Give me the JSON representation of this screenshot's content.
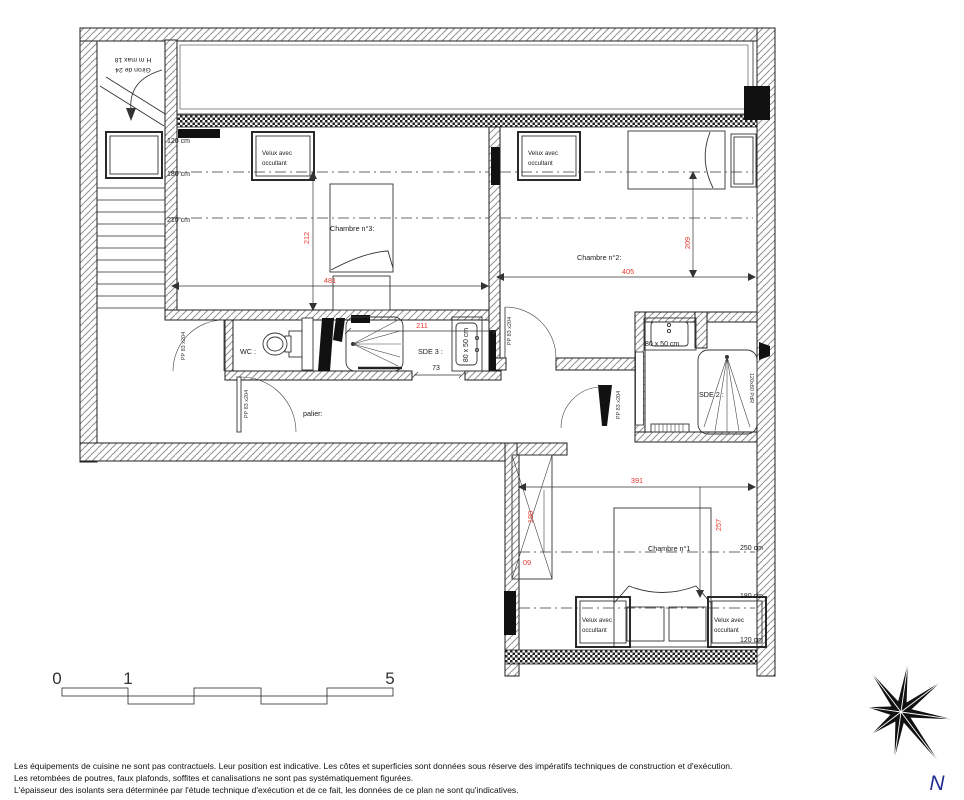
{
  "plan": {
    "rooms": {
      "bedroom3": "Chambre n°3:",
      "bedroom2": "Chambre n°2:",
      "bedroom1": "Chambre n°1",
      "wc": "WC :",
      "sde3": "SDE 3 :",
      "sde2": "SDE 2 :",
      "landing": "palier:"
    },
    "velux": {
      "line1": "Velux avec",
      "line2": "occultant"
    },
    "door_label": "PP 83 x204",
    "fixtures": {
      "basin_sde3": "80 x 50 cm",
      "basin_sde2": "80 x 50 cm",
      "shower_sde2": "120x80 PdR"
    },
    "stairs": {
      "line1": "Giron de 24",
      "line2": "H m max 18"
    },
    "dims_red": {
      "bedroom3_height": "212",
      "bedroom3_width": "481",
      "sde3_width": "211",
      "bedroom2_width": "405",
      "bedroom2_height": "209",
      "bedroom1_width": "391",
      "bedroom1_height": "257",
      "closet_height": "180",
      "closet_width": "60"
    },
    "dims_black": {
      "shower_door": "73"
    },
    "ceiling_heights": {
      "top_120": "120 cm",
      "top_180": "180 cm",
      "top_210": "210 cm",
      "c1_250": "250 cm",
      "c1_180": "180 cm",
      "c1_120": "120 cm"
    }
  },
  "scale_bar": {
    "tick0": "0",
    "tick1": "1",
    "tick5": "5"
  },
  "compass": {
    "north": "N"
  },
  "footer": {
    "line1": "Les équipements de cuisine ne sont pas contractuels. Leur position est indicative. Les côtes et superficies sont données sous réserve des impératifs techniques de construction et d'exécution.",
    "line2": "Les retombées de poutres, faux plafonds, soffites et canalisations ne sont pas systématiquement figurées.",
    "line3": "L'épaisseur des isolants sera déterminée par l'étude technique d'exécution et de ce fait, les données de ce plan ne sont qu'indicatives."
  },
  "colors": {
    "dim_red": "#e8392b",
    "line_dark": "#1f1f1f",
    "north_blue": "#232d8f"
  }
}
